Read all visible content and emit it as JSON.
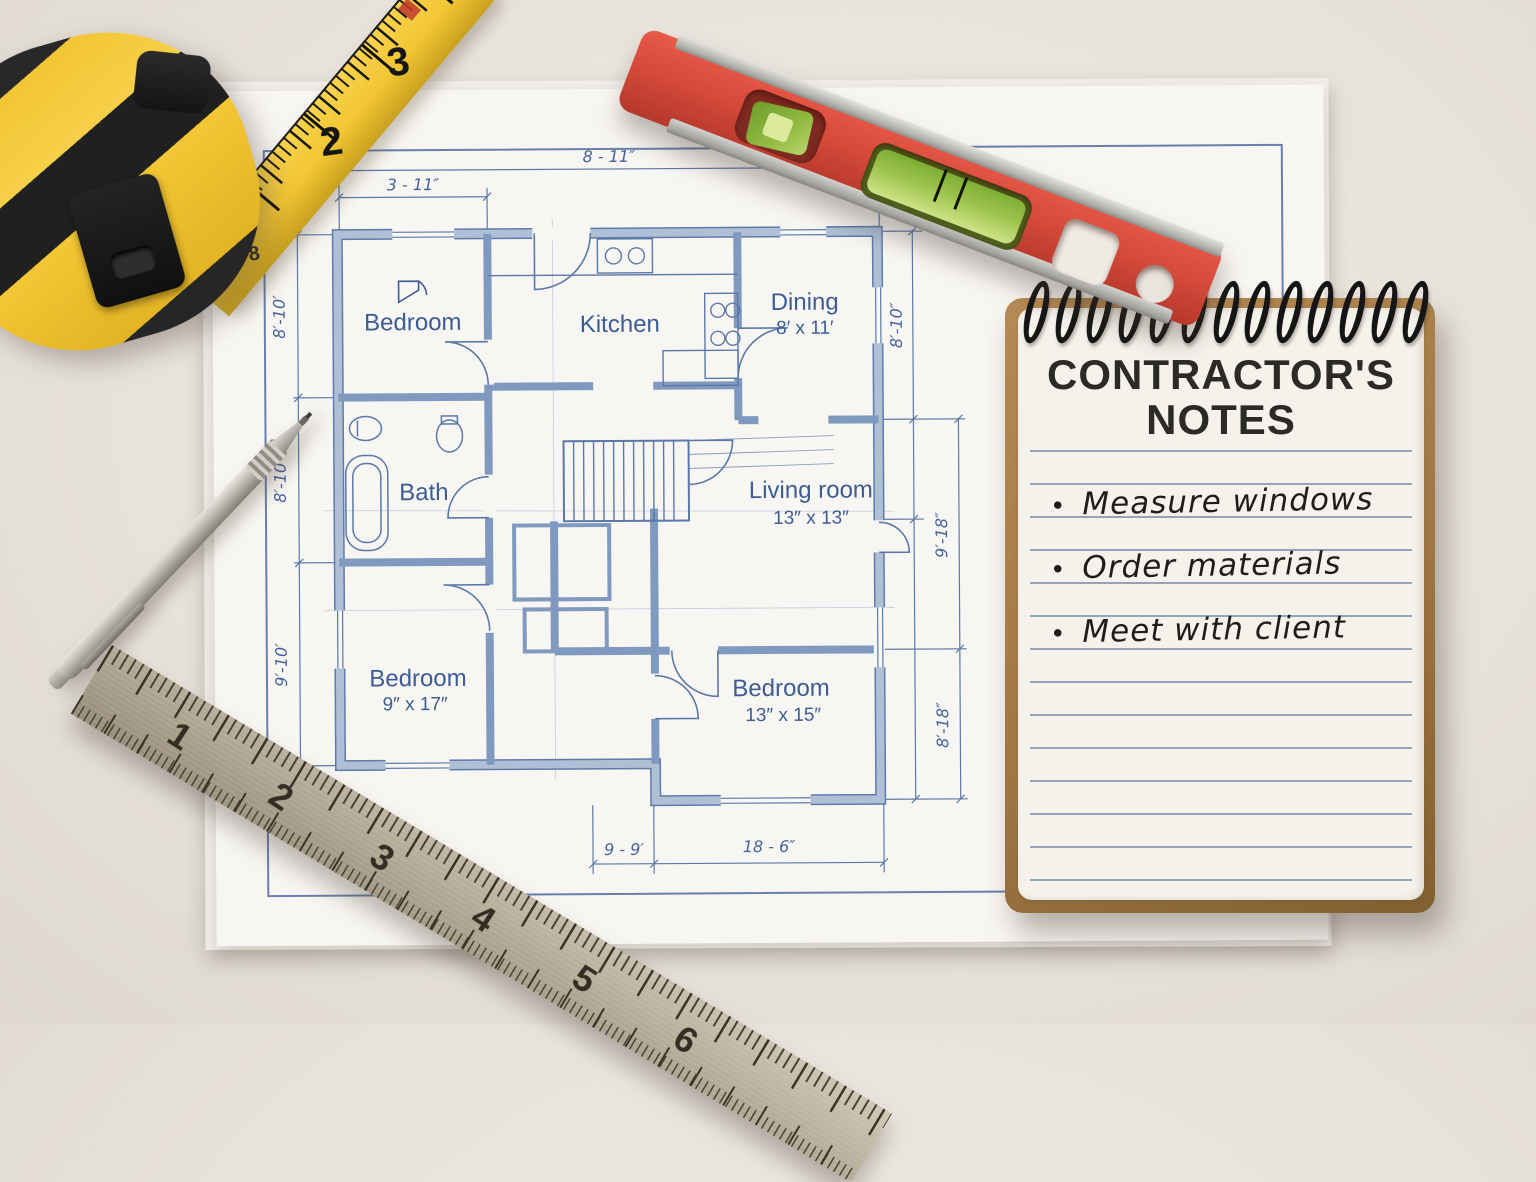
{
  "blueprint": {
    "rooms": [
      {
        "name": "Bedroom",
        "size": ""
      },
      {
        "name": "Kitchen",
        "size": ""
      },
      {
        "name": "Dining",
        "size": "8′ x 11′"
      },
      {
        "name": "Bath",
        "size": ""
      },
      {
        "name": "Living room",
        "size": "13″ x 13″"
      },
      {
        "name": "Bedroom",
        "size": "9″ x 17″"
      },
      {
        "name": "Bedroom",
        "size": "13″ x 15″"
      }
    ],
    "dimensions": {
      "top_full": "8 - 11″",
      "top_left": "3 - 11″",
      "left_upper": "8′-10′",
      "left_middle": "8′-10′",
      "left_lower": "9′-10′",
      "right_upper": "8′-10″",
      "right_middle": "9′-18″",
      "right_lower": "8′-18″",
      "bottom_left": "9 - 9′",
      "bottom_right": "18 - 6″"
    }
  },
  "notebook": {
    "title_line1": "CONTRACTOR'S",
    "title_line2": "NOTES",
    "bullet": "•",
    "items": [
      "Measure windows",
      "Order materials",
      "Meet with client"
    ]
  },
  "ruler": {
    "numbers": [
      "1",
      "2",
      "3",
      "4",
      "5",
      "6"
    ]
  },
  "tape": {
    "numbers": [
      "2",
      "3"
    ],
    "small_numbers": [
      "8"
    ]
  },
  "colors": {
    "blueprint_blue": "#4f6f9f",
    "wall_fill": "#aebfd6",
    "label_blue": "#3c5c93",
    "level_red": "#d64a3a",
    "tape_yellow": "#f2c634",
    "vial_green": "#8fb93e",
    "steel": "#b3aa96",
    "cardboard": "#a97f4f",
    "page_cream": "#f5f2ec",
    "ink": "#232120"
  }
}
